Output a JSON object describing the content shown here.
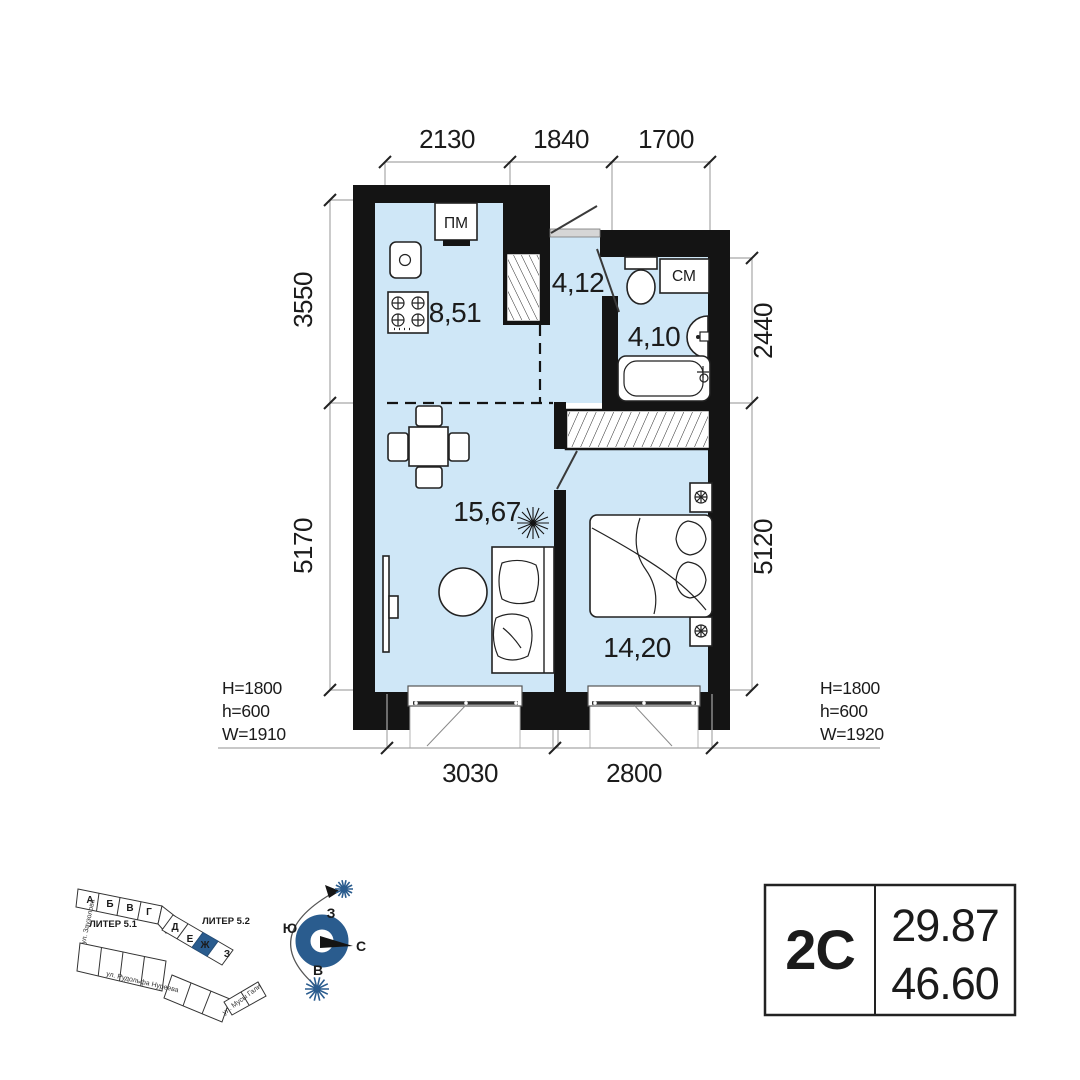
{
  "dims": {
    "top": [
      "2130",
      "1840",
      "1700"
    ],
    "left": [
      "3550",
      "5170"
    ],
    "right": [
      "2440",
      "5120"
    ],
    "bottom": [
      "3030",
      "2800"
    ]
  },
  "rooms": {
    "kitchen": "8,51",
    "hall": "4,12",
    "bath": "4,10",
    "living": "15,67",
    "bedroom": "14,20"
  },
  "appliances": {
    "dishwasher": "ПМ",
    "washer": "СМ"
  },
  "windows": {
    "left": {
      "H": "H=1800",
      "h": "h=600",
      "W": "W=1910"
    },
    "right": {
      "H": "H=1800",
      "h": "h=600",
      "W": "W=1920"
    }
  },
  "summary": {
    "type": "2С",
    "living_area": "29.87",
    "total_area": "46.60"
  },
  "site": {
    "liter_1": "ЛИТЕР 5.1",
    "liter_2": "ЛИТЕР 5.2",
    "blocks": [
      "А",
      "Б",
      "В",
      "Г",
      "Д",
      "Е",
      "Ж",
      "З"
    ],
    "streets": [
      "ул. Заузолова",
      "ул. Рудольфа Нуреева",
      "ул. Мусы Гали"
    ]
  },
  "compass": {
    "north": "С",
    "south": "Ю",
    "west": "З",
    "east": "В"
  },
  "colors": {
    "accent": "#2a5c8e",
    "room": "#cfe7f7",
    "wall": "#141414",
    "dim": "#a8a8a8"
  }
}
